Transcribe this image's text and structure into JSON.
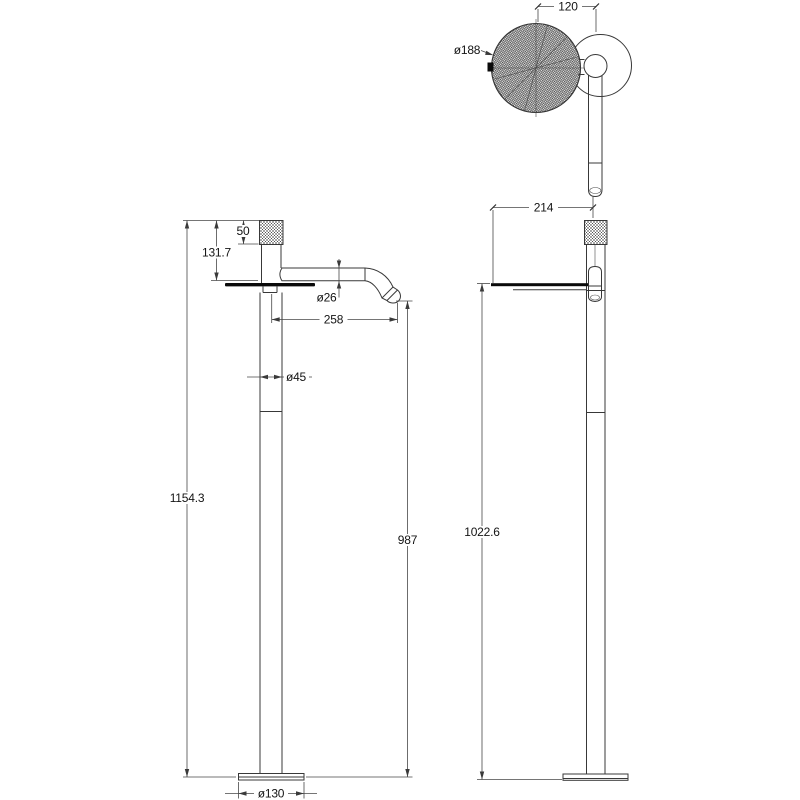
{
  "colors": {
    "line": "#383838",
    "text": "#141414",
    "background": "#ffffff"
  },
  "views": {
    "top_view": {
      "dims": {
        "handle_offset": "120",
        "head_diameter": "ø188"
      }
    },
    "front_view": {
      "dims": {
        "knob_height": "50",
        "top_to_spout": "131.7",
        "spout_diameter": "ø26",
        "spout_reach": "258",
        "column_diameter": "ø45",
        "overall_height": "1154.3",
        "spout_outlet_height": "987",
        "base_diameter": "ø130"
      }
    },
    "side_view": {
      "dims": {
        "tray_depth": "214",
        "tray_height": "1022.6"
      }
    }
  }
}
